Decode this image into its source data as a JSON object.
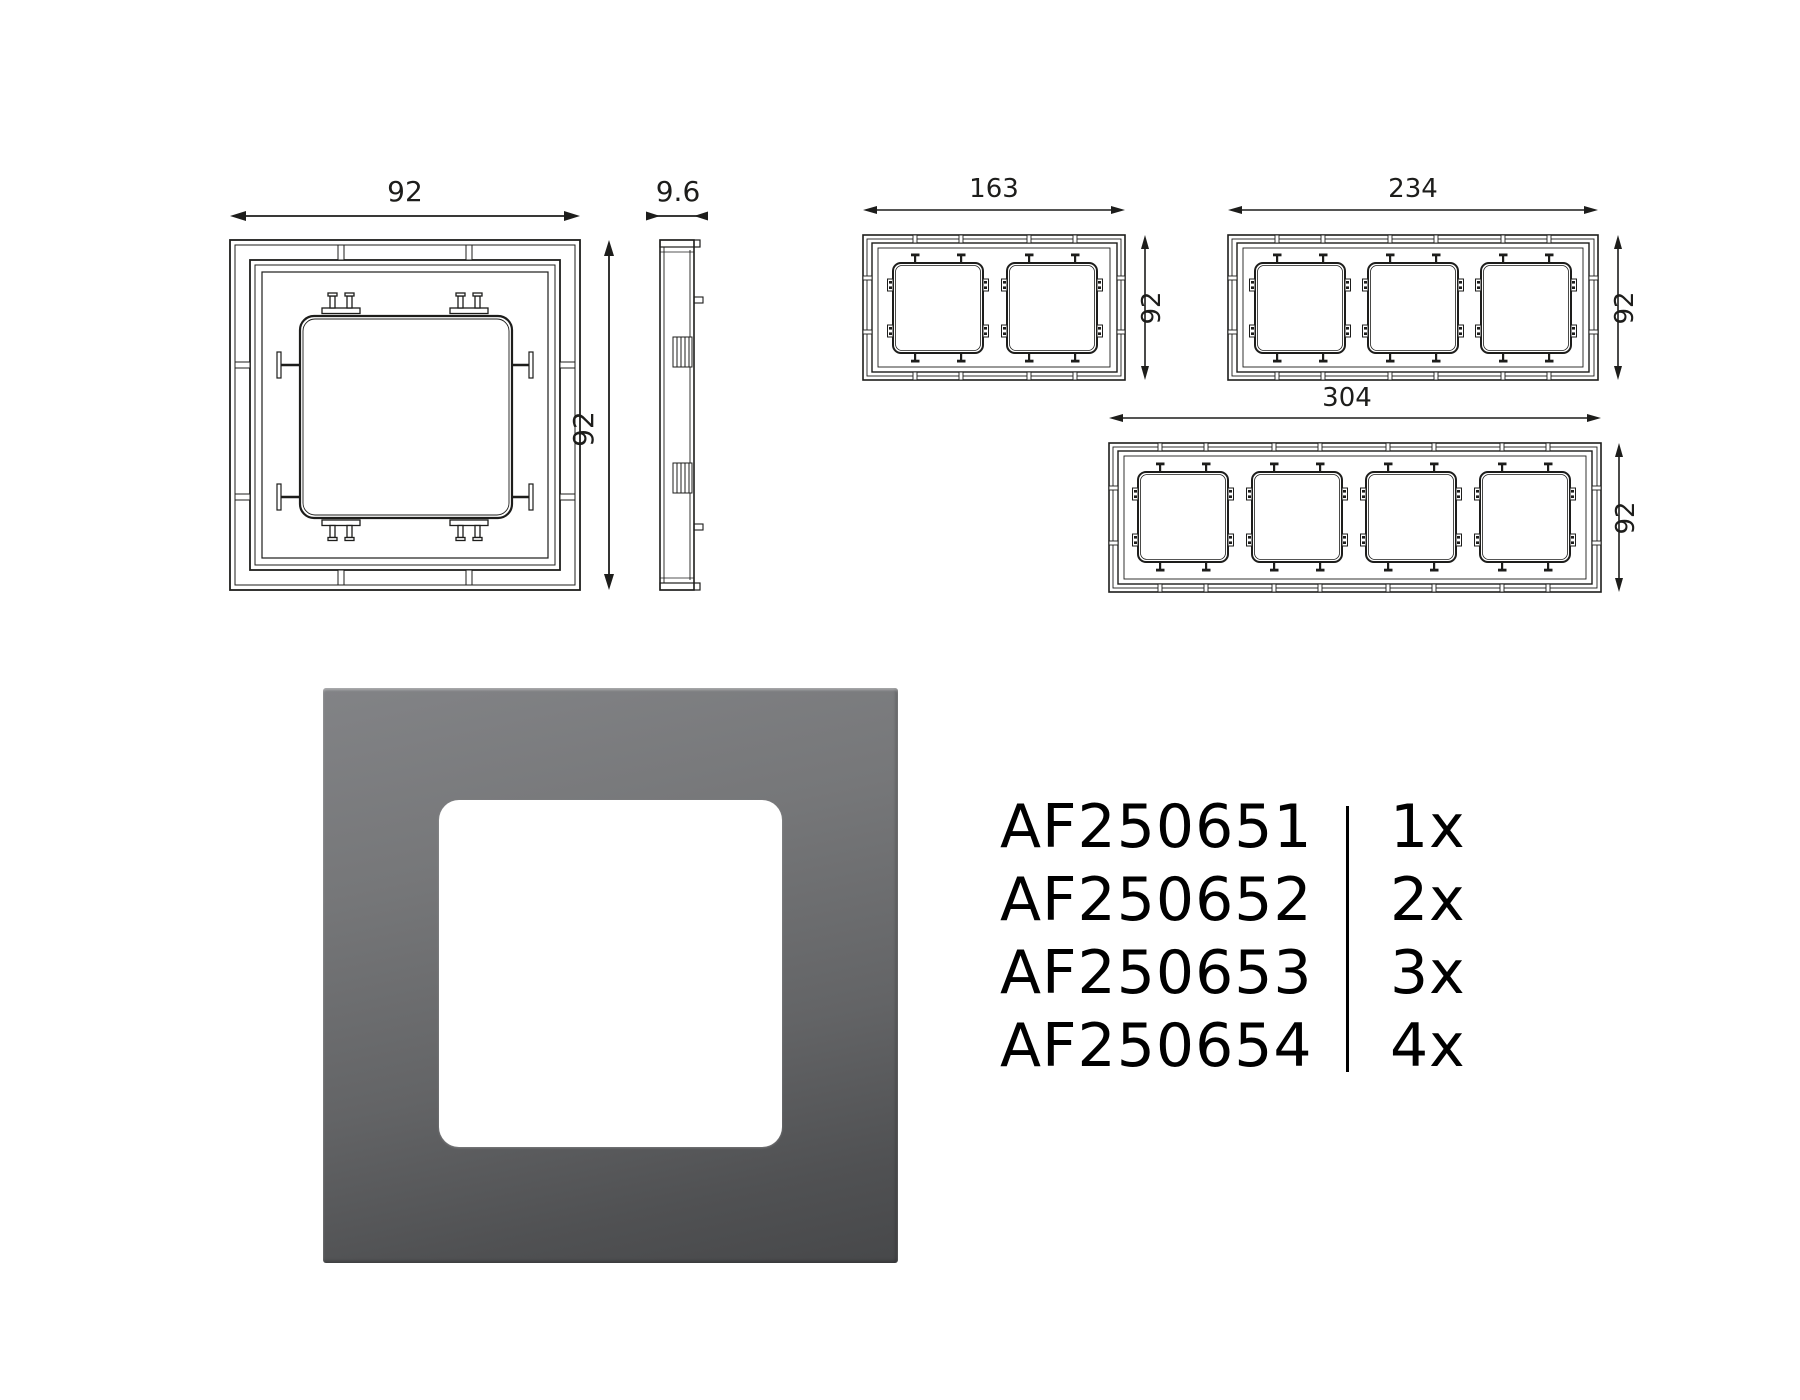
{
  "drawings": {
    "single_front": {
      "width_label": "92",
      "height_label": "92"
    },
    "side_view": {
      "depth_label": "9.6"
    },
    "two_gang": {
      "width_label": "163",
      "height_label": "92"
    },
    "three_gang": {
      "width_label": "234",
      "height_label": "92"
    },
    "four_gang": {
      "width_label": "304",
      "height_label": "92"
    }
  },
  "product": {
    "frame_color_top": "#828386",
    "frame_color_bottom": "#47484a",
    "window_color": "#ffffff",
    "line_color": "#1d1d1b"
  },
  "parts": [
    {
      "code": "AF250651",
      "qty": "1x"
    },
    {
      "code": "AF250652",
      "qty": "2x"
    },
    {
      "code": "AF250653",
      "qty": "3x"
    },
    {
      "code": "AF250654",
      "qty": "4x"
    }
  ]
}
